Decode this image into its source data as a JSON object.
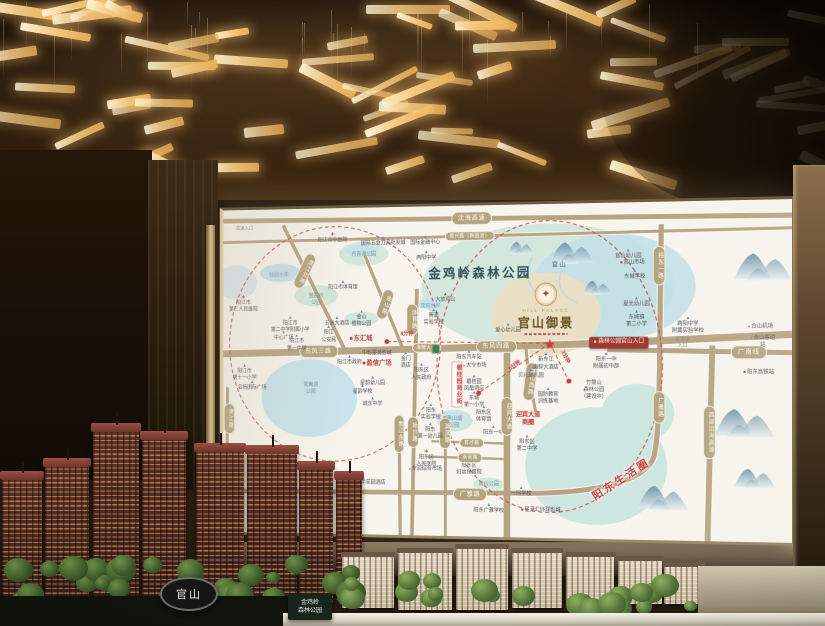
{
  "scene": {
    "tower_sign": "官山",
    "park_sign": "金鸡岭\n森林公园"
  },
  "map": {
    "title": "金鸡岭森林公园",
    "logo": {
      "en": "HILL PALACE",
      "cn": "官山御景"
    },
    "accent_red": "#cc3f36",
    "road_tan": "#b5a37e",
    "labels": [
      {
        "t": "沈海高速",
        "x": 45.4,
        "y": 3.9,
        "k": "h"
      },
      {
        "t": "振兴路（新国道）",
        "x": 45.0,
        "y": 9.2,
        "k": "hs"
      },
      {
        "t": "高速入口",
        "x": 4.0,
        "y": 5.8,
        "k": "pl"
      },
      {
        "t": "阳江市中医院",
        "x": 20.3,
        "y": 9.4,
        "k": "pc"
      },
      {
        "t": "国际五金刀具批发城",
        "x": 29.5,
        "y": 10.4,
        "k": "p"
      },
      {
        "t": "国际金融中心",
        "x": 37.1,
        "y": 10.6,
        "k": "p"
      },
      {
        "t": "两阳中学",
        "x": 37.3,
        "y": 15.0,
        "k": "p"
      },
      {
        "t": "丹青湖公园",
        "x": 26.0,
        "y": 14.5,
        "k": "pk"
      },
      {
        "t": "漠江北路",
        "x": 15.2,
        "y": 19.1,
        "k": "v",
        "r": 27
      },
      {
        "t": "独园水库",
        "x": 10.4,
        "y": 20.7,
        "k": "lk"
      },
      {
        "t": "阳江市体育馆",
        "x": 22.2,
        "y": 23.7,
        "k": "p"
      },
      {
        "t": "独园岭\n公园",
        "x": 17.3,
        "y": 28.1,
        "k": "pk"
      },
      {
        "t": "阳江市\n第三人民医院",
        "x": 3.8,
        "y": 29.4,
        "k": "pc"
      },
      {
        "t": "金山\n植物公园",
        "x": 25.6,
        "y": 34.0,
        "k": "p"
      },
      {
        "t": "金山路",
        "x": 29.8,
        "y": 29.6,
        "k": "v",
        "r": 20
      },
      {
        "t": "放鸡水库",
        "x": 38.0,
        "y": 30.5,
        "k": "lk"
      },
      {
        "t": "大放鸡山",
        "x": 40.7,
        "y": 28.0,
        "k": "mt"
      },
      {
        "t": "菁源\n实验学校",
        "x": 38.6,
        "y": 33.6,
        "k": "p"
      },
      {
        "t": "阳江市\n第二中学附属小学",
        "x": 12.5,
        "y": 35.7,
        "k": "p"
      },
      {
        "t": "五洲大酒店",
        "x": 21.1,
        "y": 34.9,
        "k": "p"
      },
      {
        "t": "体育路",
        "x": 34.8,
        "y": 34.3,
        "k": "v"
      },
      {
        "t": "东汇城",
        "x": 25.5,
        "y": 40.2,
        "k": "pr"
      },
      {
        "t": "8分钟",
        "x": 33.8,
        "y": 39.0,
        "k": "tm"
      },
      {
        "t": "海陵大堤",
        "x": 37.3,
        "y": 42.9,
        "k": "hs"
      },
      {
        "t": "东风三路",
        "x": 17.7,
        "y": 44.0,
        "k": "h"
      },
      {
        "t": "中心广场",
        "x": 11.3,
        "y": 39.3,
        "k": "p"
      },
      {
        "t": "阳江\n公安局",
        "x": 19.6,
        "y": 38.8,
        "k": "p"
      },
      {
        "t": "阳江市\n第一中学",
        "x": 13.7,
        "y": 41.4,
        "k": "p"
      },
      {
        "t": "阳江市政府",
        "x": 23.4,
        "y": 46.9,
        "k": "p"
      },
      {
        "t": "阳江市\n第十一小学",
        "x": 4.0,
        "y": 50.6,
        "k": "p"
      },
      {
        "t": "名扬国际广场",
        "x": 5.4,
        "y": 54.6,
        "k": "p"
      },
      {
        "t": "鸳鸯湖\n公园",
        "x": 16.3,
        "y": 55.6,
        "k": "pk"
      },
      {
        "t": "中影星美影城",
        "x": 28.1,
        "y": 44.9,
        "k": "pd"
      },
      {
        "t": "盈信广场",
        "x": 28.4,
        "y": 47.6,
        "k": "pr"
      },
      {
        "t": "星韵幼儿园",
        "x": 27.6,
        "y": 53.2,
        "k": "p"
      },
      {
        "t": "星韵学校",
        "x": 25.8,
        "y": 55.8,
        "k": "p"
      },
      {
        "t": "城东中学",
        "x": 27.6,
        "y": 59.6,
        "k": "p"
      },
      {
        "t": "新江东路",
        "x": 32.4,
        "y": 69.3,
        "k": "v"
      },
      {
        "t": "始兴路",
        "x": 34.9,
        "y": 68.7,
        "k": "v"
      },
      {
        "t": "湖滨路",
        "x": 40.7,
        "y": 68.8,
        "k": "v"
      },
      {
        "t": "阳东\n实验学校",
        "x": 38.1,
        "y": 62.4,
        "k": "p"
      },
      {
        "t": "阳东\n第一幼儿园",
        "x": 38.0,
        "y": 68.3,
        "k": "p"
      },
      {
        "t": "阳东区\n人民医院",
        "x": 37.3,
        "y": 76.8,
        "k": "pc"
      },
      {
        "t": "东润综合市场",
        "x": 37.1,
        "y": 80.0,
        "k": "pd"
      },
      {
        "t": "广丰花园酒店",
        "x": 27.0,
        "y": 84.2,
        "k": "pd"
      },
      {
        "t": "阳东区\n妇幼保健院",
        "x": 44.9,
        "y": 79.0,
        "k": "pc"
      },
      {
        "t": "岗山公园",
        "x": 48.4,
        "y": 84.2,
        "k": "pk"
      },
      {
        "t": "广雅路",
        "x": 45.1,
        "y": 87.3,
        "k": "h"
      },
      {
        "t": "阳东广雅学校",
        "x": 48.4,
        "y": 91.6,
        "k": "p"
      },
      {
        "t": "一问学校",
        "x": 54.1,
        "y": 86.4,
        "k": "p"
      },
      {
        "t": "星港汇环球影城",
        "x": 57.5,
        "y": 91.8,
        "k": "pm"
      },
      {
        "t": "育才路",
        "x": 45.4,
        "y": 71.8,
        "k": "hs"
      },
      {
        "t": "永安路",
        "x": 45.1,
        "y": 76.3,
        "k": "hs"
      },
      {
        "t": "燕山湖\n公园",
        "x": 42.3,
        "y": 65.6,
        "k": "pk"
      },
      {
        "t": "东城\n第一小学",
        "x": 45.8,
        "y": 58.8,
        "k": "p"
      },
      {
        "t": "阳东区\n体育馆",
        "x": 47.5,
        "y": 63.0,
        "k": "p"
      },
      {
        "t": "阳东一中",
        "x": 49.2,
        "y": 68.0,
        "k": "p"
      },
      {
        "t": "阳东区\n第二中学",
        "x": 55.1,
        "y": 71.8,
        "k": "p"
      },
      {
        "t": "迎宾大道",
        "x": 51.6,
        "y": 63.8,
        "k": "v"
      },
      {
        "t": "迎宾大道\n商圈",
        "x": 55.3,
        "y": 64.4,
        "k": "rm"
      },
      {
        "t": "环山西路",
        "x": 55.7,
        "y": 53.2,
        "k": "v",
        "r": 7
      },
      {
        "t": "贝儿幼儿园",
        "x": 55.8,
        "y": 51.0,
        "k": "p"
      },
      {
        "t": "国防教育\n训练基地",
        "x": 58.8,
        "y": 57.6,
        "k": "p"
      },
      {
        "t": "新东江\n海鲜大酒店",
        "x": 58.4,
        "y": 47.2,
        "k": "p"
      },
      {
        "t": "竹筒山\n森林公园\n（建设中）",
        "x": 66.7,
        "y": 55.8,
        "k": "dk"
      },
      {
        "t": "阳东一中\n附属初中部",
        "x": 68.8,
        "y": 47.0,
        "k": "p"
      },
      {
        "t": "5分钟",
        "x": 53.0,
        "y": 48.6,
        "k": "tm",
        "r": -36
      },
      {
        "t": "3分钟",
        "x": 61.6,
        "y": 45.8,
        "k": "tm",
        "r": 62
      },
      {
        "t": "碧桂园\n凤凰酒店",
        "x": 45.8,
        "y": 53.8,
        "k": "p"
      },
      {
        "t": "大令市场",
        "x": 45.9,
        "y": 48.6,
        "k": "pd"
      },
      {
        "t": "阳东汽车站",
        "x": 44.9,
        "y": 45.4,
        "k": "p"
      },
      {
        "t": "碧桂园商业街",
        "x": 42.8,
        "y": 54.0,
        "k": "rv"
      },
      {
        "t": "金门\n酒店",
        "x": 33.6,
        "y": 46.8,
        "k": "p"
      },
      {
        "t": "阳东区\n人民政府",
        "x": 36.4,
        "y": 50.4,
        "k": "p"
      },
      {
        "t": "东风四路",
        "x": 49.7,
        "y": 42.6,
        "k": "h"
      },
      {
        "t": "★",
        "x": 59.1,
        "y": 41.8,
        "k": "st"
      },
      {
        "t": "官山",
        "x": 60.7,
        "y": 18.3,
        "k": "ml"
      },
      {
        "t": "金鸡岭森林公园",
        "x": 46.8,
        "y": 20.6,
        "k": "tt"
      },
      {
        "t": "爱心幼儿园",
        "x": 51.8,
        "y": 37.2,
        "k": "p"
      },
      {
        "t": "森林公园官山入口",
        "x": 70.9,
        "y": 41.6,
        "k": "en"
      },
      {
        "t": "官山幼儿园",
        "x": 72.6,
        "y": 15.5,
        "k": "p"
      },
      {
        "t": "官山市场",
        "x": 73.3,
        "y": 17.9,
        "k": "pm"
      },
      {
        "t": "东城学校",
        "x": 73.7,
        "y": 21.4,
        "k": "p"
      },
      {
        "t": "星光幼儿园",
        "x": 74.0,
        "y": 29.7,
        "k": "p"
      },
      {
        "t": "东城镇\n第二小学",
        "x": 74.0,
        "y": 34.5,
        "k": "p"
      },
      {
        "t": "两阳中学\n附属实验学校",
        "x": 82.7,
        "y": 36.6,
        "k": "p"
      },
      {
        "t": "往高速\n入口",
        "x": 81.8,
        "y": 41.8,
        "k": "pl"
      },
      {
        "t": "裕东一路",
        "x": 77.8,
        "y": 19.0,
        "k": "v"
      },
      {
        "t": "广雅路",
        "x": 77.8,
        "y": 60.8,
        "k": "v"
      },
      {
        "t": "西部沿海高速",
        "x": 86.3,
        "y": 68.1,
        "k": "v"
      },
      {
        "t": "广南线",
        "x": 92.9,
        "y": 44.6,
        "k": "h"
      },
      {
        "t": "合山机场",
        "x": 94.8,
        "y": 37.2,
        "k": "pd"
      },
      {
        "t": "合山客运站",
        "x": 95.2,
        "y": 41.6,
        "k": "pd"
      },
      {
        "t": "阳东高铁站",
        "x": 94.5,
        "y": 50.6,
        "k": "pt"
      },
      {
        "t": "阳东生活圈",
        "x": 71.4,
        "y": 82.2,
        "k": "zn",
        "r": -33
      },
      {
        "t": "漠江路",
        "x": 1.1,
        "y": 64.8,
        "k": "v"
      }
    ]
  }
}
